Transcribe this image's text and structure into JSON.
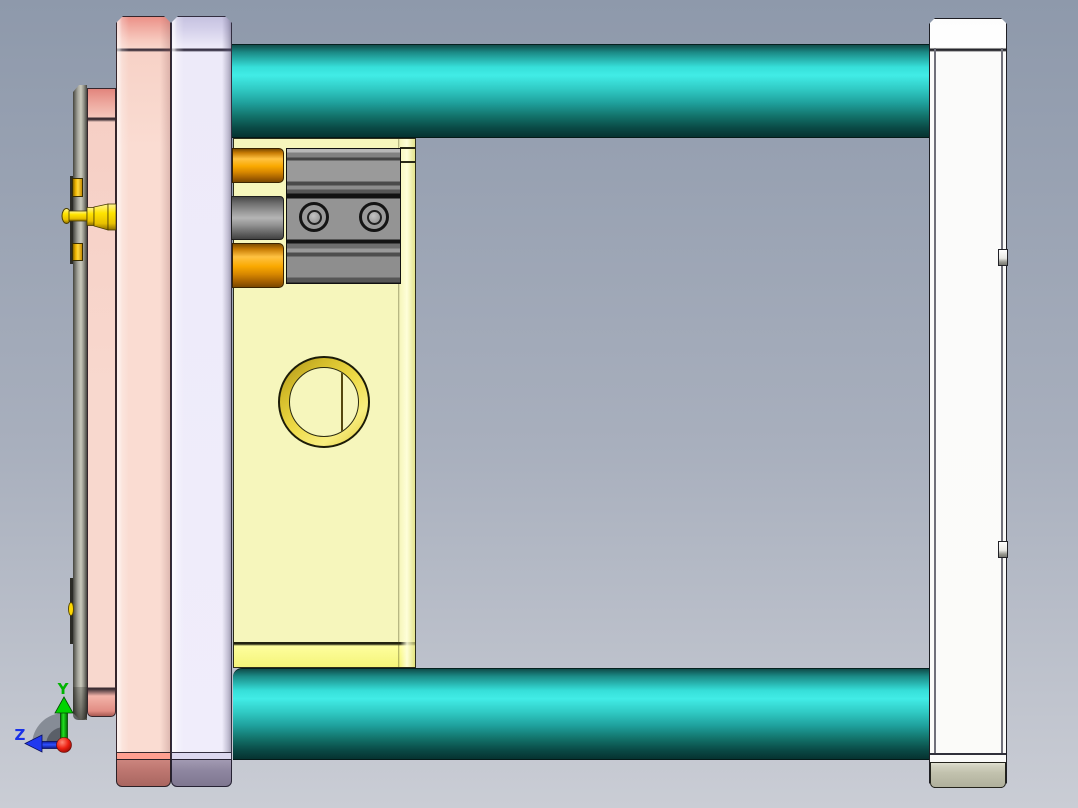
{
  "axis_triad": {
    "labels": {
      "y": "Y",
      "z": "Z"
    }
  },
  "colors": {
    "bg_top": "#8e99ab",
    "bg_mid": "#a8afbd",
    "bg_bottom": "#cacdd5",
    "pink_plate_top": "#ec9188",
    "pink_plate_light": "#fadcd2",
    "pink_bright_strip": "#ff9f90",
    "pink_block": "#bd7670",
    "lavender_top": "#c6c2e0",
    "lavender_light": "#f0edfb",
    "lavender_block": "#8e86a0",
    "yellow_plate": "#f6f6bc",
    "yellow_bright": "#f4f479",
    "teal_bright": "#41ece6",
    "teal_dark": "#063230",
    "orange_bright": "#ffc242",
    "orange_dark": "#7e4c00",
    "gray_cyl_light": "#b4b4b4",
    "block_gray": "#949494",
    "ring_yellow": "#eeda46",
    "white_plate": "#fbfbf9",
    "khaki_block": "#c2c2ae",
    "sprue_yellow": "#ffe400",
    "axis_y": "#00c800",
    "axis_z": "#2038f0",
    "axis_origin": "#e01010"
  }
}
